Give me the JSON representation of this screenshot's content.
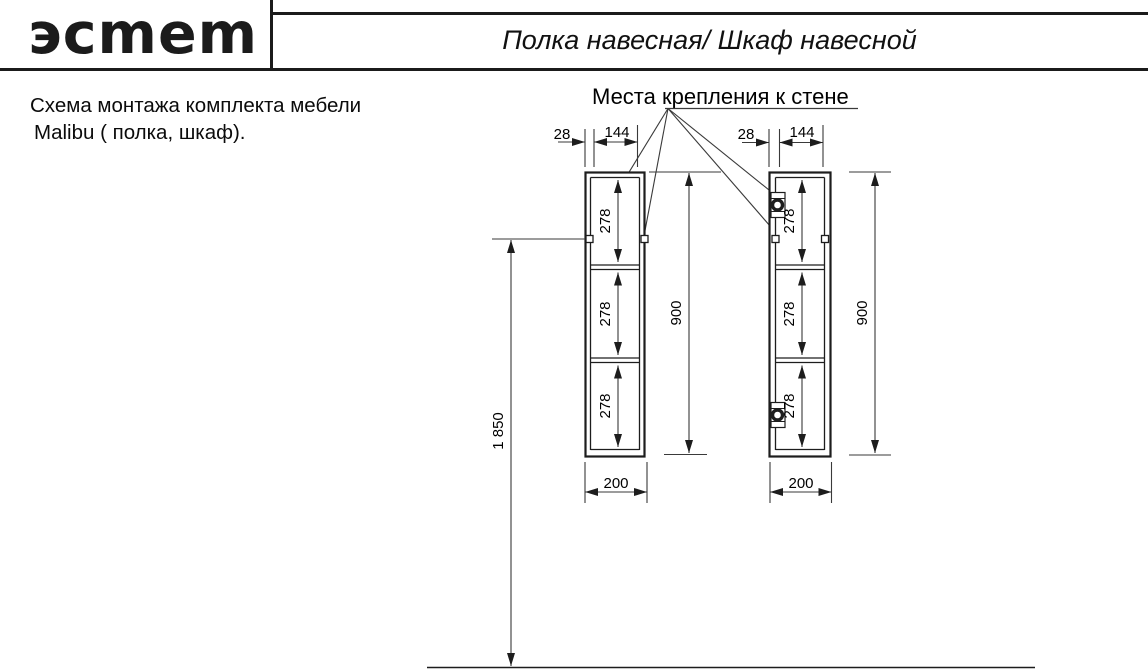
{
  "header": {
    "logo": "эсmem",
    "title": "Полка навесная/ Шкаф навесной"
  },
  "note": {
    "line1": "Схема монтажа комплекта мебели",
    "line2": "Malibu ( полка, шкаф)."
  },
  "drawing": {
    "callout": "Места крепления к стене",
    "dims": {
      "offset": "28",
      "spacing": "144",
      "section": "278",
      "height": "900",
      "width": "200",
      "mount_height": "1 850"
    },
    "colors": {
      "line": "#1d1d1d",
      "thin_line": "#3a3a3a"
    }
  }
}
